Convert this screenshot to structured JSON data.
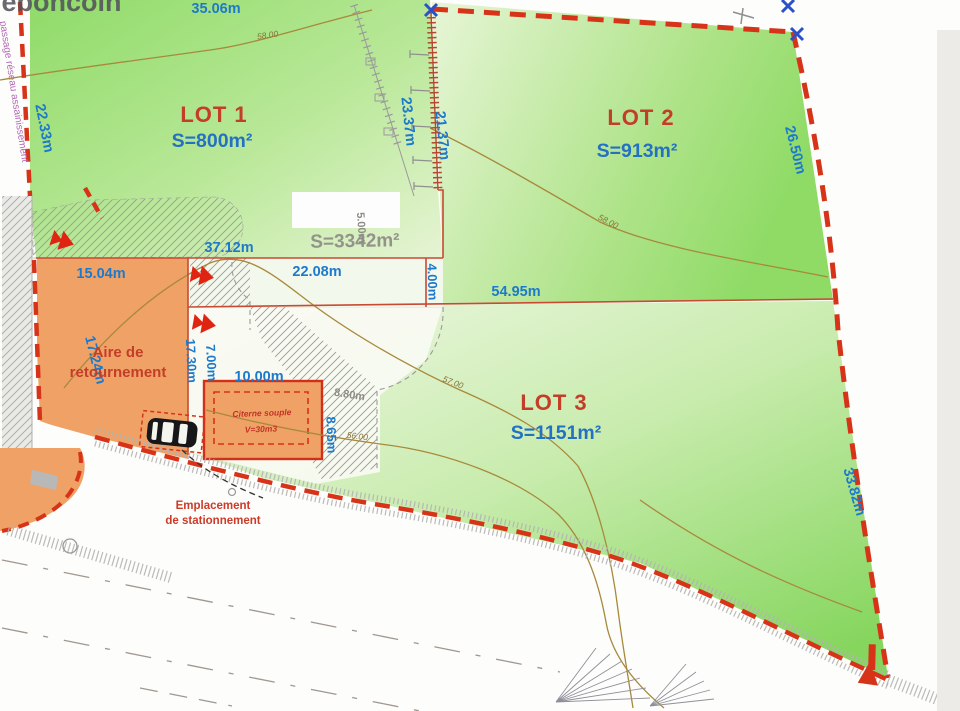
{
  "watermark": "leboncoin",
  "easement_label": "passage réseau assainissement",
  "lots": [
    {
      "label": "LOT 1",
      "area": "S=800m²"
    },
    {
      "label": "LOT 2",
      "area": "S=913m²"
    },
    {
      "label": "LOT 3",
      "area": "S=1151m²"
    }
  ],
  "total_area": "S=3342m²",
  "dimensions": [
    "35.06m",
    "22.33m",
    "23.37m",
    "21.37m",
    "26.50m",
    "37.12m",
    "22.08m",
    "54.95m",
    "4.00m",
    "15.04m",
    "17.24m",
    "17.30m",
    "7.00m",
    "10.00m",
    "8.65m",
    "33.82m"
  ],
  "gray_dimensions": [
    "5.00m",
    "8.80m"
  ],
  "contour_labels": [
    "58.00",
    "58.00",
    "57.00",
    "56.00"
  ],
  "annotations": {
    "turning_area": [
      "Aire de",
      "retournement"
    ],
    "parking": [
      "Emplacement",
      "de stationnement"
    ],
    "cistern": [
      "Citerne souple",
      "V=30m3"
    ]
  },
  "colors": {
    "boundary_red": "#d63318",
    "thin_red": "#c84a33",
    "dimension_blue": "#1d79cb",
    "lot_label_red": "#c43d28",
    "area_blue": "#2471c4",
    "parcel_green": "#96dd6e",
    "parcel_green_pale": "#e9f6da",
    "access_orange": "#f0a266",
    "contour_olive": "#a8893c",
    "hatch_gray": "#9a9a9a",
    "easement_purple": "#b468b8"
  }
}
